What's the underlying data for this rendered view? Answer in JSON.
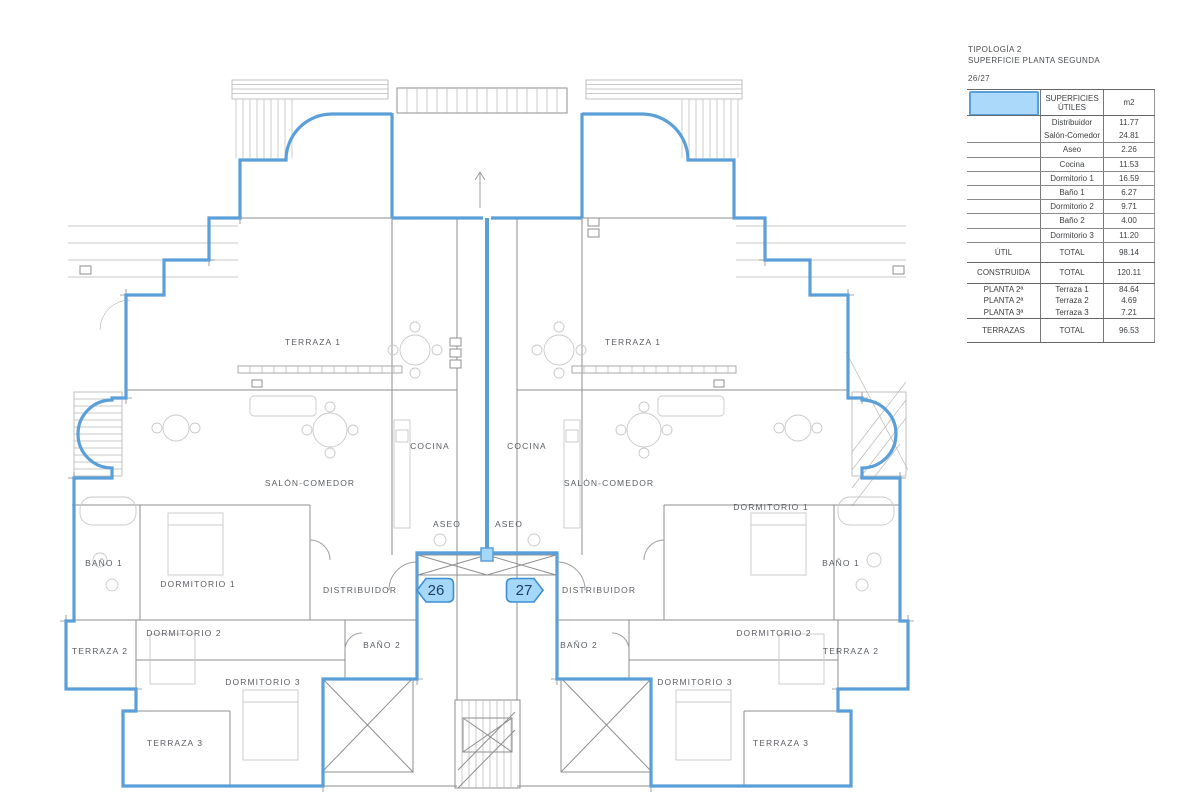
{
  "header": {
    "line1": "TIPOLOGÍA 2",
    "line2": "SUPERFICIE PLANTA SEGUNDA",
    "units_ref": "26/27"
  },
  "table": {
    "legend_color": "#aad9f9",
    "header": {
      "col_label_line1": "SUPERFICIES",
      "col_label_line2": "ÚTILES",
      "col_unit": "m2"
    },
    "rooms": [
      {
        "group": "",
        "label": "Distribuidor",
        "value": "11.77"
      },
      {
        "group": "",
        "label": "Salón-Comedor",
        "value": "24.81"
      },
      {
        "group": "",
        "label": "Aseo",
        "value": "2.26"
      },
      {
        "group": "",
        "label": "Cocina",
        "value": "11.53"
      },
      {
        "group": "",
        "label": "Dormitorio 1",
        "value": "16.59"
      },
      {
        "group": "",
        "label": "Baño 1",
        "value": "6.27"
      },
      {
        "group": "",
        "label": "Dormitorio 2",
        "value": "9.71"
      },
      {
        "group": "",
        "label": "Baño 2",
        "value": "4.00"
      },
      {
        "group": "",
        "label": "Dormitorio 3",
        "value": "11.20"
      }
    ],
    "util_total": {
      "group": "ÚTIL",
      "label": "TOTAL",
      "value": "98.14"
    },
    "constr_total": {
      "group": "CONSTRUIDA",
      "label": "TOTAL",
      "value": "120.11"
    },
    "terraces": [
      {
        "group": "PLANTA 2ª",
        "label": "Terraza 1",
        "value": "84.64"
      },
      {
        "group": "PLANTA 2ª",
        "label": "Terraza 2",
        "value": "4.69"
      },
      {
        "group": "PLANTA 3ª",
        "label": "Terraza 3",
        "value": "7.21"
      }
    ],
    "terrace_total": {
      "group": "TERRAZAS",
      "label": "TOTAL",
      "value": "96.53"
    }
  },
  "plan": {
    "accent_color": "#5b9fd8",
    "badge_fill": "#a5d7f8",
    "badge_border": "#3d8fd1",
    "badges": [
      {
        "number": "26",
        "x": 437,
        "y": 590
      },
      {
        "number": "27",
        "x": 522,
        "y": 590
      }
    ],
    "labels": [
      {
        "text": "TERRAZA 1",
        "x": 313,
        "y": 342
      },
      {
        "text": "TERRAZA 1",
        "x": 633,
        "y": 342
      },
      {
        "text": "COCINA",
        "x": 430,
        "y": 446
      },
      {
        "text": "COCINA",
        "x": 527,
        "y": 446
      },
      {
        "text": "SALÓN-COMEDOR",
        "x": 310,
        "y": 483
      },
      {
        "text": "SALÓN-COMEDOR",
        "x": 609,
        "y": 483
      },
      {
        "text": "ASEO",
        "x": 447,
        "y": 524
      },
      {
        "text": "ASEO",
        "x": 509,
        "y": 524
      },
      {
        "text": "DORMITORIO 1",
        "x": 198,
        "y": 584
      },
      {
        "text": "DORMITORIO 1",
        "x": 771,
        "y": 507
      },
      {
        "text": "BAÑO 1",
        "x": 104,
        "y": 563
      },
      {
        "text": "BAÑO 1",
        "x": 841,
        "y": 563
      },
      {
        "text": "DISTRIBUIDOR",
        "x": 360,
        "y": 590
      },
      {
        "text": "DISTRIBUIDOR",
        "x": 599,
        "y": 590
      },
      {
        "text": "DORMITORIO 2",
        "x": 184,
        "y": 633
      },
      {
        "text": "DORMITORIO 2",
        "x": 774,
        "y": 633
      },
      {
        "text": "TERRAZA 2",
        "x": 100,
        "y": 651
      },
      {
        "text": "TERRAZA 2",
        "x": 851,
        "y": 651
      },
      {
        "text": "BAÑO 2",
        "x": 382,
        "y": 645
      },
      {
        "text": "BAÑO 2",
        "x": 579,
        "y": 645
      },
      {
        "text": "DORMITORIO 3",
        "x": 263,
        "y": 682
      },
      {
        "text": "DORMITORIO 3",
        "x": 695,
        "y": 682
      },
      {
        "text": "TERRAZA 3",
        "x": 175,
        "y": 743
      },
      {
        "text": "TERRAZA 3",
        "x": 781,
        "y": 743
      }
    ]
  }
}
